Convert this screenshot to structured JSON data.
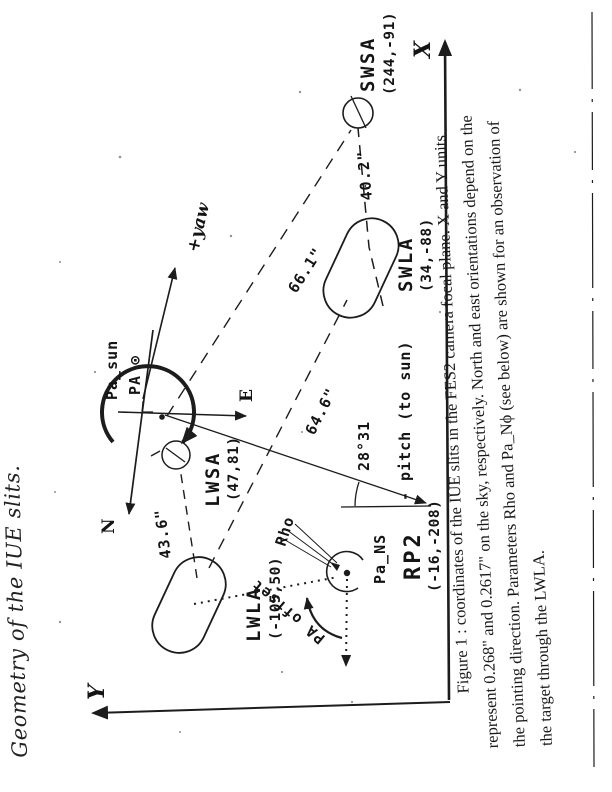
{
  "title": {
    "handwritten": "Geometry of the IUE slits."
  },
  "diagram": {
    "axes": {
      "x": "X",
      "y": "Y"
    },
    "directions": {
      "north": "N",
      "east": "E",
      "yaw": "+yaw"
    },
    "sun": {
      "pa_sun": "Pa_sun",
      "pa_symbol": "PA ⊙"
    },
    "pitch": {
      "label": "- pitch (to sun)",
      "angle": "28°31"
    },
    "apertures": {
      "swsa": {
        "name": "SWSA",
        "coords": "(244,-91)"
      },
      "swla": {
        "name": "SWLA",
        "coords": "(34,-88)"
      },
      "lwsa": {
        "name": "LWSA",
        "coords": "(47,81)"
      },
      "lwla": {
        "name": "LWLA",
        "coords": "(-105,50)"
      },
      "rp2": {
        "name": "RP2",
        "coords": "(-16,-208)"
      }
    },
    "distances": {
      "swsa_swla": "40.2\"",
      "center_swsa": "66.1\"",
      "swla_lwla": "64.6\"",
      "lwsa_lwla": "43.6\""
    },
    "target": {
      "pa_ns": "Pa_NS",
      "rho": "Rho",
      "pa_offset": "PA offset"
    }
  },
  "caption": {
    "line1": "Figure 1 : coordinates of the IUE slits in the FES2 camera focal plane. X and Y units",
    "line2": "represent 0.268\" and 0.2617\" on the sky, respectively. North and east orientations depend on the",
    "line3": "the pointing direction. Parameters Rho and Pa_Nϕ (see below) are shown for an observation of",
    "line4": "the target through the LWLA."
  }
}
